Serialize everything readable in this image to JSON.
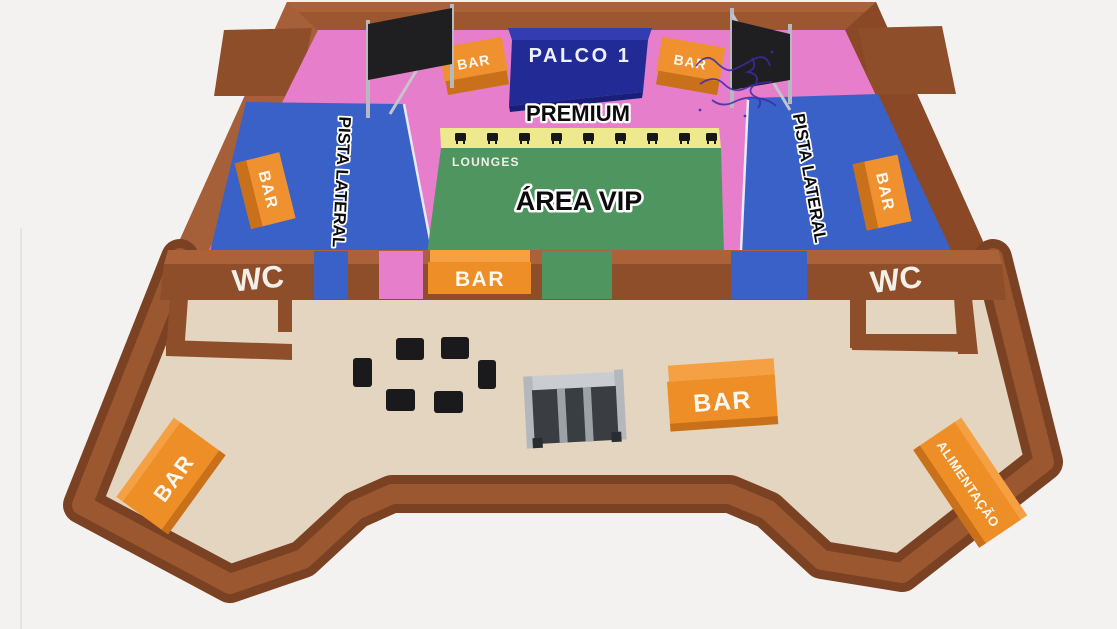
{
  "title": "Mapa do evento - planta 3D",
  "colors": {
    "background": "#F4F2F0",
    "wall": "#9D5730",
    "wall_dark": "#8A4826",
    "wall_light": "#AC6238",
    "border_dark": "#7A4123",
    "border_light": "#9B5830",
    "floor_premium_pink": "#E77ECB",
    "floor_vip_green": "#4E9560",
    "floor_pista_blue": "#3A61C7",
    "floor_lower_beige": "#E3D5BF",
    "lounge_strip_yellow": "#EFE98E",
    "stage_blue": "#2A2F9E",
    "bar_orange": "#EE8E26",
    "bar_orange_light": "#F5A143",
    "bar_orange_dark": "#C8711A",
    "screen_black": "#1F1F22",
    "metal_gray": "#BDC1C6",
    "furniture_black": "#1A1A1C",
    "scribble_purple": "#3C2AA8"
  },
  "stage": {
    "label": "PALCO 1"
  },
  "zones": {
    "premium": {
      "label": "PREMIUM"
    },
    "vip": {
      "label": "ÁREA VIP"
    },
    "lounges": {
      "label": "LOUNGES"
    },
    "pista_left": {
      "label": "PISTA LATERAL"
    },
    "pista_right": {
      "label": "PISTA LATERAL"
    }
  },
  "facilities": {
    "wc_left": {
      "label": "WC"
    },
    "wc_right": {
      "label": "WC"
    },
    "food": {
      "label": "ALIMENTAÇÃO"
    },
    "bars": {
      "stage_left": "BAR",
      "stage_right": "BAR",
      "pista_left": "BAR",
      "pista_right": "BAR",
      "vip_wall": "BAR",
      "lower_center": "BAR",
      "lower_left": "BAR"
    }
  }
}
